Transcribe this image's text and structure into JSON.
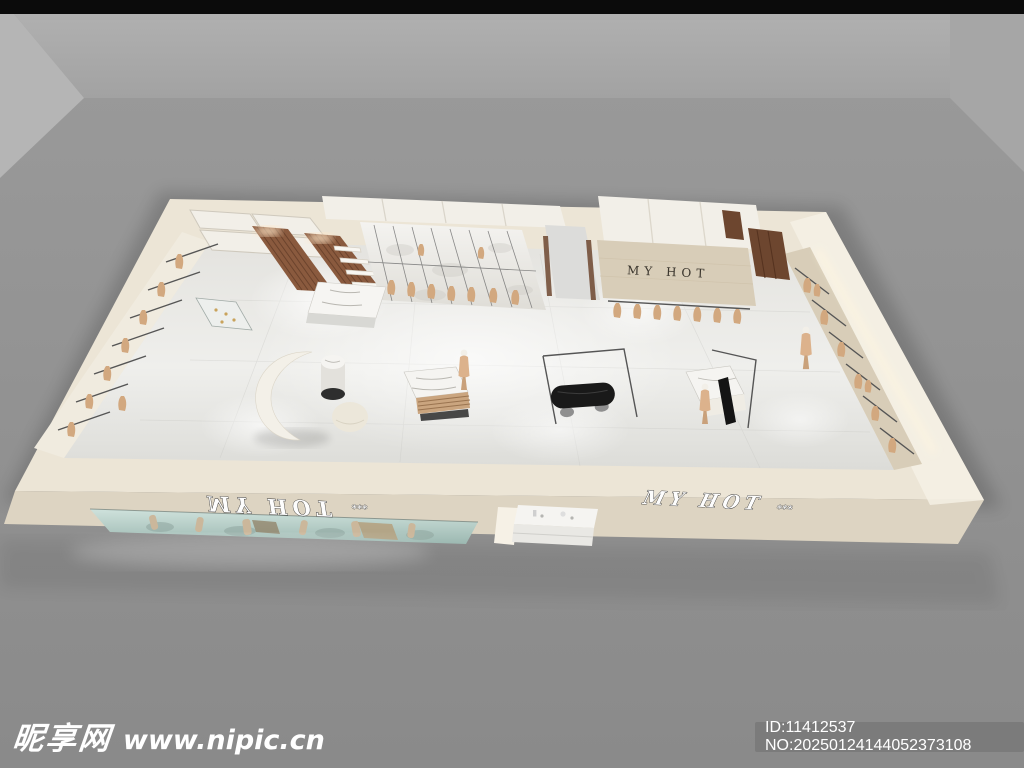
{
  "scene": {
    "description": "Bird's-eye 3D render of a clothing store interior in a gray studio room",
    "colors": {
      "bg_top": "#0b0b0b",
      "bg_wall": "#a9a9a9",
      "bg_wall_left": "#b3b3b3",
      "bg_wall_right": "#a4a4a4",
      "bg_floor": "#949494",
      "store_cream": "#ece5d6",
      "store_cream_dark": "#ddd4c2",
      "store_cream_bright": "#f6f1e6",
      "floor_marble": "#e9e9e6",
      "travertine": "#d8cdb8",
      "wood": "#8a5a3e",
      "dark_wood": "#6d462f",
      "glass_teal": "#b9d2cb",
      "clothing_tan": "#d2a87f",
      "bench_black": "#191919",
      "rail_gray": "#555555",
      "sign_dark": "#3a352d",
      "sign_white": "#fdfdfd",
      "watermark_white": "#ffffff",
      "idbox_gray": "#7b7b7b"
    }
  },
  "signs": {
    "back_wall": "MY HOT",
    "front_left": "MY HOT",
    "front_left_suffix": "***",
    "front_right": "MY HOT",
    "front_right_suffix": "***"
  },
  "watermark": {
    "site_name": "昵享网",
    "site_url": "www.nipic.cn"
  },
  "id_bar": {
    "text": "ID:11412537 NO:20250124144052373108"
  }
}
